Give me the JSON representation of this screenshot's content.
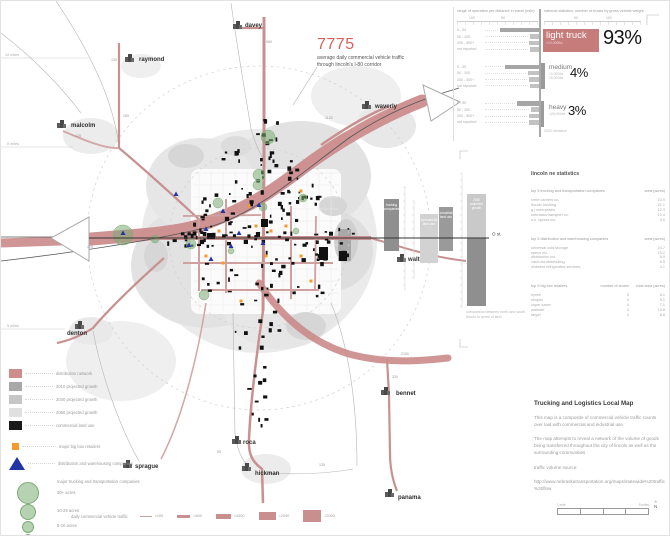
{
  "map": {
    "highlight_number": "7775",
    "highlight_caption_line1": "average daily commercial vehicle traffic",
    "highlight_caption_line2": "through lincoln's I-80 corridor",
    "mile_markers": [
      {
        "text": "10 miles",
        "x": 4,
        "y": 55
      },
      {
        "text": "5 miles",
        "x": 6,
        "y": 144
      },
      {
        "text": "5 miles",
        "x": 6,
        "y": 326
      }
    ],
    "towns": [
      {
        "name": "davey",
        "x": 244,
        "y": 26,
        "ix": 232,
        "iy": 20
      },
      {
        "name": "raymond",
        "x": 138,
        "y": 60,
        "ix": 124,
        "iy": 53
      },
      {
        "name": "malcolm",
        "x": 70,
        "y": 126,
        "ix": 56,
        "iy": 119
      },
      {
        "name": "waverly",
        "x": 374,
        "y": 107,
        "ix": 361,
        "iy": 100
      },
      {
        "name": "walton",
        "x": 407,
        "y": 260,
        "ix": 396,
        "iy": 253
      },
      {
        "name": "denton",
        "x": 66,
        "y": 334,
        "ix": 74,
        "iy": 320
      },
      {
        "name": "bennet",
        "x": 395,
        "y": 394,
        "ix": 380,
        "iy": 386
      },
      {
        "name": "roca",
        "x": 242,
        "y": 443,
        "ix": 231,
        "iy": 435
      },
      {
        "name": "sprague",
        "x": 134,
        "y": 467,
        "ix": 122,
        "iy": 459
      },
      {
        "name": "hickman",
        "x": 254,
        "y": 474,
        "ix": 241,
        "iy": 462
      },
      {
        "name": "panama",
        "x": 397,
        "y": 498,
        "ix": 384,
        "iy": 488
      }
    ],
    "road_labels": [
      {
        "text": "980",
        "x": 265,
        "y": 42
      },
      {
        "text": "130",
        "x": 110,
        "y": 60
      },
      {
        "text": "265",
        "x": 122,
        "y": 116
      },
      {
        "text": "125",
        "x": 74,
        "y": 136
      },
      {
        "text": "1120",
        "x": 324,
        "y": 118
      },
      {
        "text": "225",
        "x": 86,
        "y": 247
      },
      {
        "text": "2150",
        "x": 400,
        "y": 354
      },
      {
        "text": "330",
        "x": 391,
        "y": 377
      },
      {
        "text": "135",
        "x": 318,
        "y": 465
      },
      {
        "text": "55",
        "x": 216,
        "y": 452
      }
    ]
  },
  "weight_panel": {
    "left_title": "range of operation per distance in travel (mile)",
    "right_title": "national statistics: number of trucks by gross vehicle weight",
    "left_axis_ticks": [
      "100",
      "50"
    ],
    "right_axis_ticks": [
      "50",
      "100"
    ],
    "row_labels": [
      "0 - 50",
      "50 - 200",
      "200 - 500+",
      "not reported"
    ],
    "groups": [
      {
        "name": "light truck",
        "w1": "<10,000lbs",
        "w2": "",
        "pct": "93%",
        "range_values": [
          68,
          16,
          18,
          16
        ]
      },
      {
        "name": "medium",
        "w1": "10,000lbs",
        "w2": "26,000lbs",
        "pct": "4%",
        "range_values": [
          60,
          19,
          18,
          16
        ]
      },
      {
        "name": "heavy",
        "w1": ">26,000lbs",
        "w2": "",
        "pct": "3%",
        "range_values": [
          39,
          14,
          18,
          18
        ]
      }
    ],
    "footnote": "2002 statistics"
  },
  "lincoln_stats": {
    "title": "lincoln ne statistics",
    "tables": [
      {
        "header": "top 5 trucking and transportation companies",
        "value_header": "area (acres)",
        "rows": [
          [
            "crete carriers co.",
            "23.9"
          ],
          [
            "lincoln trucking",
            "21.1"
          ],
          [
            "g j enterprises",
            "12.3"
          ],
          [
            "nebraska transport co.",
            "10.4"
          ],
          [
            "u.s. xpress inc.",
            "9.6"
          ]
        ]
      },
      {
        "header": "top 5 distribution and warehousing companies",
        "value_header": "area (acres)",
        "rows": [
          [
            "universal cold storage",
            "24.7"
          ],
          [
            "speco inc.",
            "19.2"
          ],
          [
            "distribution inc.",
            "8.9"
          ],
          [
            "cash-wa distributing",
            "6.5"
          ],
          [
            "midwest refrigerated services",
            "4.1"
          ]
        ]
      }
    ],
    "retailers_table": {
      "header": "top 5 big box retailers",
      "col2": "number of stores",
      "col3": "total area (acres)",
      "rows": [
        [
          "hyvee",
          "5",
          "8.1"
        ],
        [
          "shopko",
          "4",
          "9.1"
        ],
        [
          "super saver",
          "4",
          "7.1"
        ],
        [
          "walmart",
          "3",
          "14.8"
        ],
        [
          "target",
          "3",
          "8.8"
        ]
      ]
    }
  },
  "comparison_chart": {
    "axis_label": "O st.",
    "note_line1": "comparison between north and south",
    "note_line2": "lincoln in acres of land",
    "bars": [
      {
        "label_lines": [
          "trucking",
          "companies"
        ],
        "x": 383,
        "w": 15,
        "above": 39,
        "below": 13,
        "color_above": "#8f8f8f",
        "color_below": "#8f8f8f"
      },
      {
        "label_lines": [
          "commercial",
          "land use"
        ],
        "x": 419,
        "w": 18,
        "above": 24,
        "below": 25,
        "color_above": "#d2d2d2",
        "color_below": "#d2d2d2"
      },
      {
        "label_lines": [
          "industrial",
          "land use"
        ],
        "x": 438,
        "w": 14,
        "above": 31,
        "below": 13,
        "color_above": "#9a9a9a",
        "color_below": "#9a9a9a"
      },
      {
        "label_lines": [
          "2030",
          "projected",
          "growth"
        ],
        "x": 466,
        "w": 19,
        "above": 44,
        "below": 68,
        "color_above": "#c9c9c9",
        "color_below": "#8f8f8f"
      }
    ]
  },
  "description": {
    "title": "Trucking and Logistics Local Map",
    "para1": "This map is a composite of commercial vehicle traffic counts over laid with commercial and industrial use.",
    "para2": "The map attempts to reveal a network of the volume of goods being transferred throughout the city of lincoln as well as the surrounding communities",
    "source_label": "traffic volume source:",
    "source_url": "http://www.nebraskatransportation.org/maps/statewide%20traffic%20flow"
  },
  "legend": {
    "area_items": [
      {
        "label": "distribution network",
        "color": "#cf8c8c"
      },
      {
        "label": "2010 projected growth",
        "color": "#a8a8a8"
      },
      {
        "label": "2040 projected growth",
        "color": "#c6c6c6"
      },
      {
        "label": "2060 projected growth",
        "color": "#e0e0e0"
      },
      {
        "label": "commercial land use",
        "color": "#1a1a1a"
      }
    ],
    "bigbox_label": "major big box retailers",
    "warehouse_label": "distribution and warehousing companies",
    "circles_title": "major trucking and transportation companies",
    "circle_items": [
      {
        "label": "30+ acres"
      },
      {
        "label": "10-29 acres"
      },
      {
        "label": "5-10 acres"
      },
      {
        "label": "1-5 acres"
      },
      {
        "label": "0-1 acres"
      }
    ]
  },
  "traffic_legend": {
    "label": "daily commercial vehicle traffic",
    "items": [
      {
        "label": "<100",
        "h": 1,
        "w": 12
      },
      {
        "label": "<500",
        "h": 3,
        "w": 13
      },
      {
        "label": "<1000",
        "h": 5,
        "w": 15
      },
      {
        "label": "<2000",
        "h": 8,
        "w": 17
      },
      {
        "label": ">2000",
        "h": 12,
        "w": 18
      }
    ]
  },
  "scale_bar": {
    "left_label": "1 mile",
    "right_label": "5 miles",
    "north_label": "N"
  },
  "colors": {
    "road_rose": "#cb8a8a",
    "accent_red": "#c77c7c",
    "highlight_red": "#d8605b",
    "orange": "#f59b2b",
    "blue": "#2334a3",
    "green": "#7bab74",
    "land_black": "#111111"
  }
}
